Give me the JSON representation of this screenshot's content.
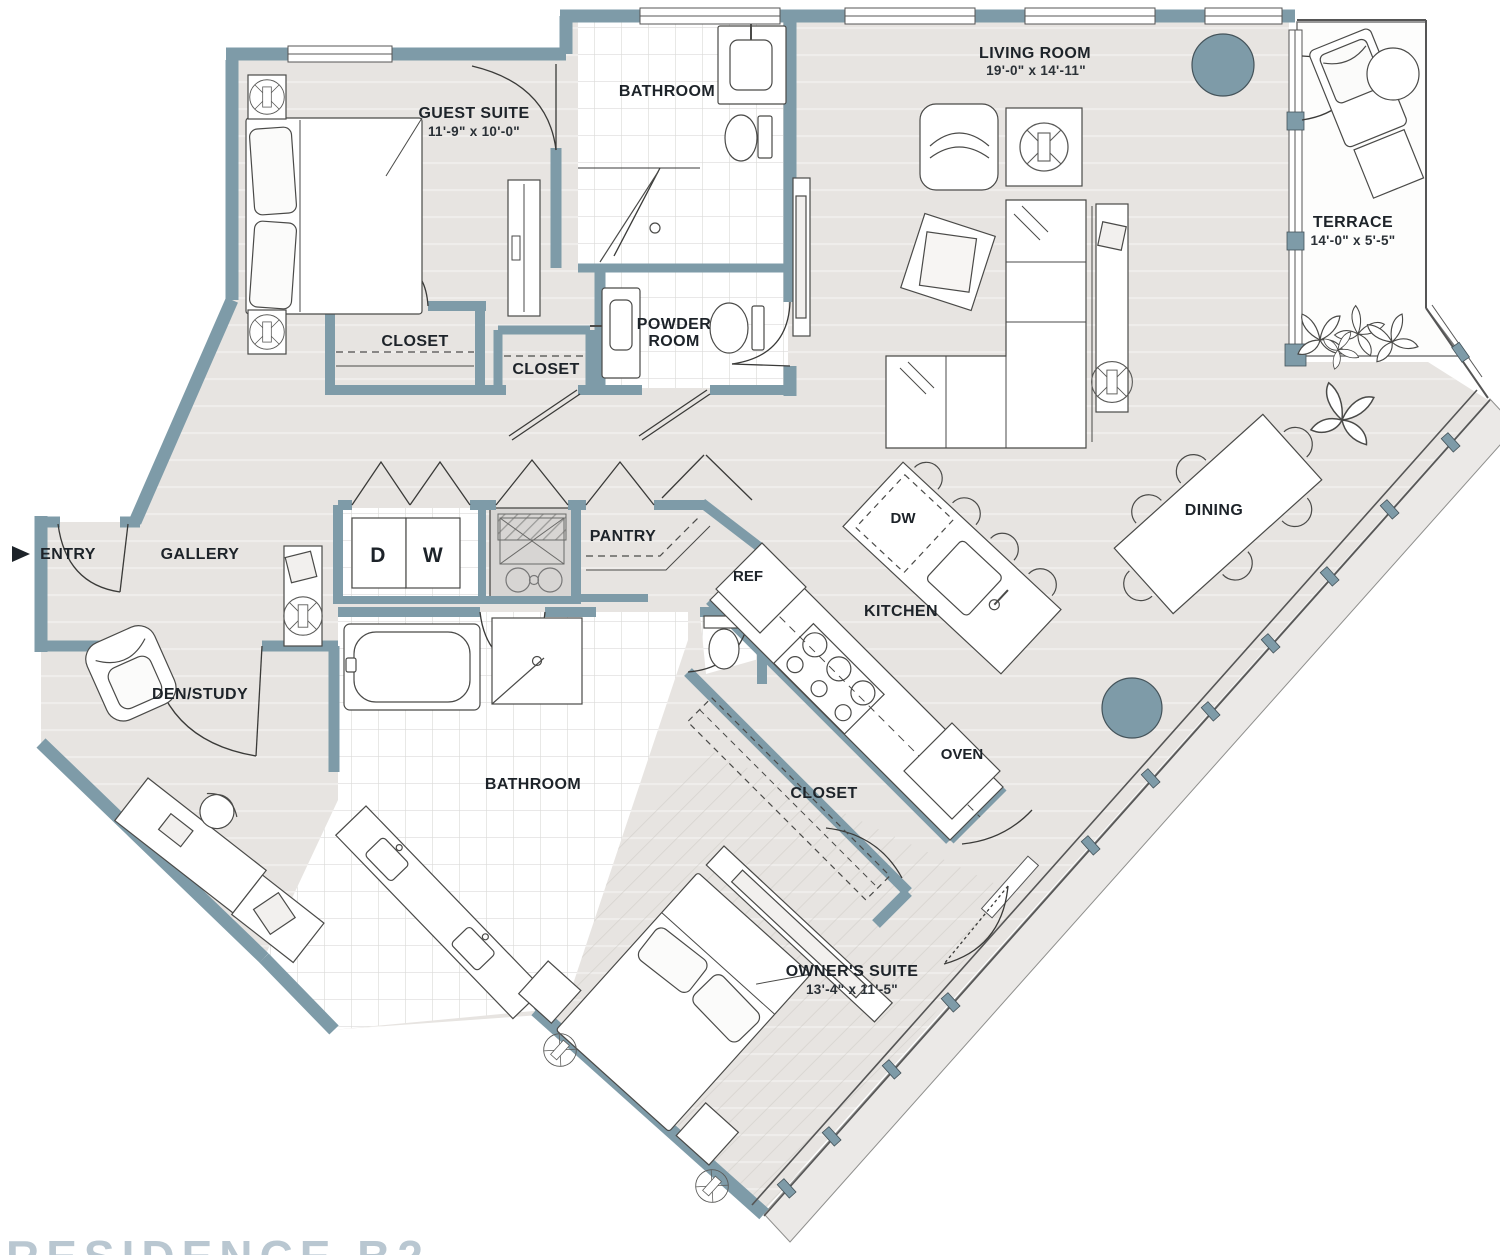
{
  "plan": {
    "partial_title": "RESIDENCE B2",
    "labels": {
      "guest_suite": {
        "name": "GUEST SUITE",
        "dims": "11'-9\" x 10'-0\""
      },
      "bathroom_top": {
        "name": "BATHROOM"
      },
      "living_room": {
        "name": "LIVING ROOM",
        "dims": "19'-0\" x 14'-11\""
      },
      "terrace": {
        "name": "TERRACE",
        "dims": "14'-0\" x 5'-5\""
      },
      "closet_guest": {
        "name": "CLOSET"
      },
      "closet_hall": {
        "name": "CLOSET"
      },
      "powder_room": {
        "line1": "POWDER",
        "line2": "ROOM"
      },
      "entry": {
        "name": "ENTRY"
      },
      "gallery": {
        "name": "GALLERY"
      },
      "den_study": {
        "name": "DEN/STUDY"
      },
      "pantry": {
        "name": "PANTRY"
      },
      "kitchen": {
        "name": "KITCHEN"
      },
      "dining": {
        "name": "DINING"
      },
      "bathroom_main": {
        "name": "BATHROOM"
      },
      "closet_owner": {
        "name": "CLOSET"
      },
      "owner_suite": {
        "name": "OWNER'S SUITE",
        "dims": "13'-4\" x 11'-5\""
      }
    },
    "appliances": {
      "dryer": "D",
      "washer": "W",
      "dishwasher": "DW",
      "refrigerator": "REF",
      "oven": "OVEN"
    },
    "colors": {
      "wall": "#7e9ba8",
      "floor": "#e7e4e1",
      "column": "#7e9ba8",
      "title": "#b9c7d1",
      "label": "#1d2329"
    }
  }
}
